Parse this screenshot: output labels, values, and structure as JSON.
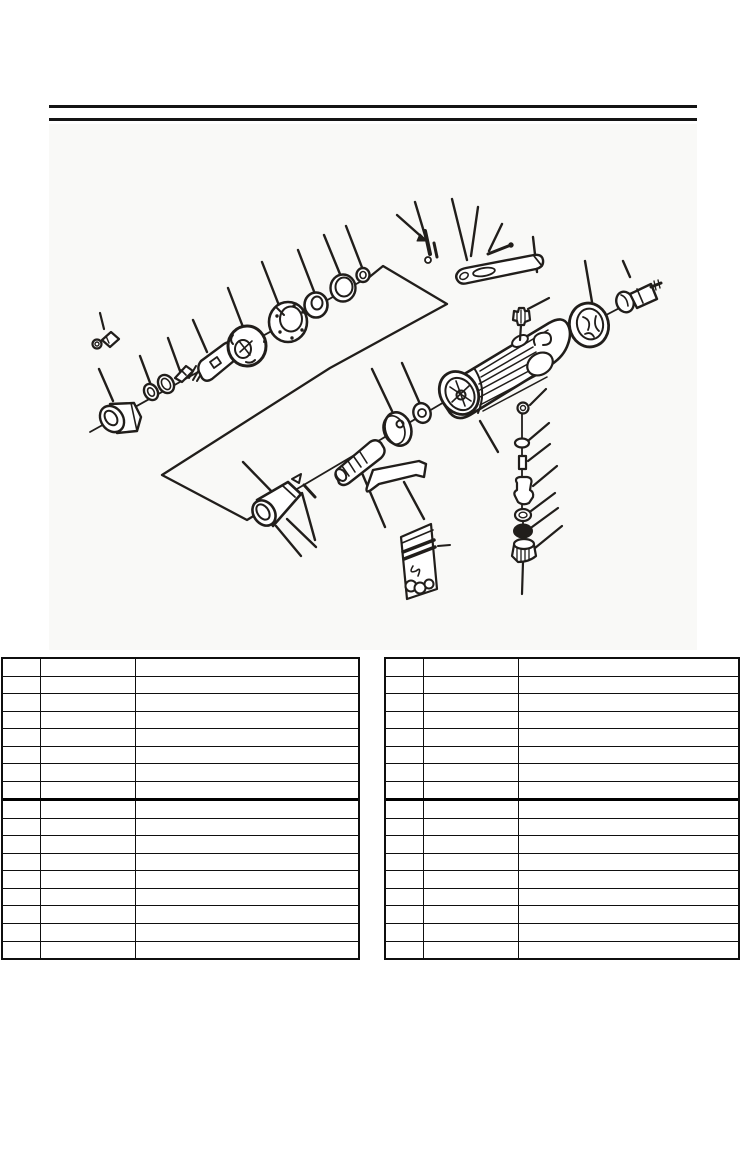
{
  "page": {
    "kind": "scanned parts-manual page",
    "background_color": "#ffffff",
    "ink_color": "#211e1b",
    "scan_tint_color": "#f9f9f7"
  },
  "header": {
    "rule_color": "#141414",
    "rules": [
      {
        "y": 105,
        "height": 3
      },
      {
        "y": 118,
        "height": 3
      }
    ]
  },
  "diagram": {
    "label": "exploded-view-parts-diagram",
    "subject": "pneumatic die grinder",
    "visible_text": [],
    "parts": [
      "grease-fitting",
      "collet-nut",
      "front-o-ring",
      "retainer-ring",
      "collet-cone",
      "spindle-spring",
      "spindle",
      "rotor",
      "motor-cylinder",
      "ball-bearing",
      "washer",
      "small-o-ring",
      "retaining-clips",
      "wrench",
      "pin-rod",
      "motor-housing",
      "speed-regulator",
      "governor-disc",
      "governor-ring",
      "air-inlet-bushing",
      "kick-pin",
      "throttle-valve-cylinder",
      "safety-lever",
      "valve-stack",
      "parts-bag",
      "rear-bearing-plate",
      "inlet-end-cap",
      "group-outline-arrow"
    ]
  },
  "tables": {
    "grid_color": "#0f0f0f",
    "left": {
      "rows": 17,
      "columns": 3,
      "col_widths_px": [
        38,
        95,
        null
      ],
      "thick_divider_after_row": 8,
      "cells_text": ""
    },
    "right": {
      "rows": 17,
      "columns": 3,
      "col_widths_px": [
        38,
        95,
        null
      ],
      "thick_divider_after_row": 8,
      "cells_text": ""
    }
  }
}
